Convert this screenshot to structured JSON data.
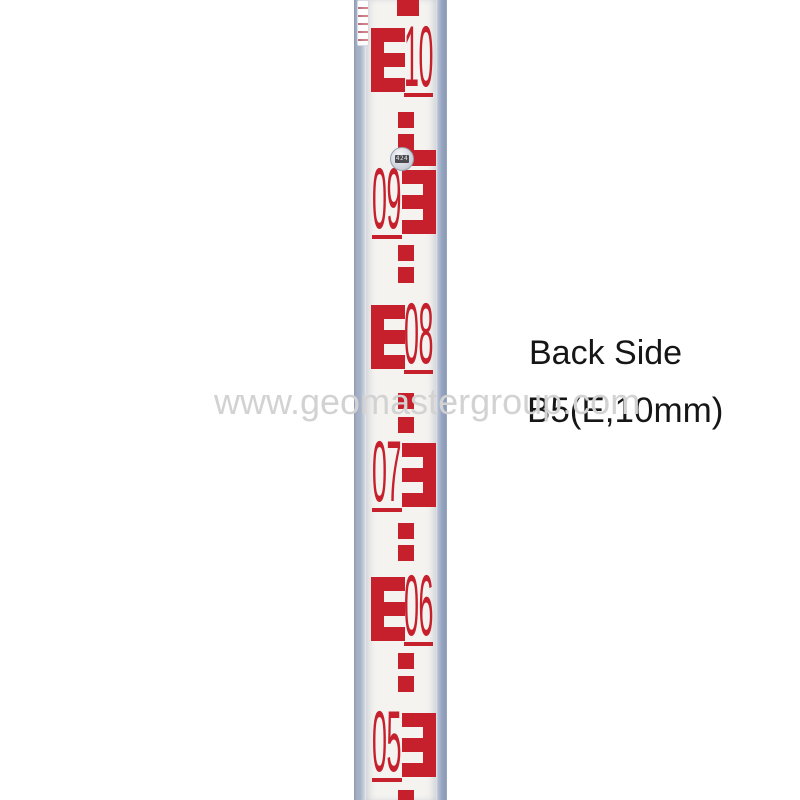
{
  "annotations": {
    "back_side_label": "Back Side",
    "model_label": "B5(E,10mm)",
    "watermark": "www.geomastergroup.com"
  },
  "staff": {
    "description": "aluminium levelling staff, back side, E-type 10mm graduations",
    "colors": {
      "graduation_red": "#c6202c",
      "face_white": "#f4f3f0",
      "rail_grey": "#a6b1c6"
    },
    "sticker_text": "424",
    "e_glyph": "E",
    "graduations": [
      {
        "digits": "10",
        "orientation": "upright",
        "top": 28
      },
      {
        "digits": "09",
        "orientation": "inverted",
        "top": 170
      },
      {
        "digits": "08",
        "orientation": "upright",
        "top": 305
      },
      {
        "digits": "07",
        "orientation": "inverted",
        "top": 443
      },
      {
        "digits": "06",
        "orientation": "upright",
        "top": 577
      },
      {
        "digits": "05",
        "orientation": "inverted",
        "top": 713
      }
    ],
    "blocks": [
      {
        "y": 0,
        "x": 31,
        "w": 22,
        "h": 16
      },
      {
        "y": 112
      },
      {
        "y": 134
      },
      {
        "y": 150,
        "x": 37,
        "w": 33
      },
      {
        "y": 245
      },
      {
        "y": 267
      },
      {
        "y": 393
      },
      {
        "y": 417
      },
      {
        "y": 523
      },
      {
        "y": 545
      },
      {
        "y": 653
      },
      {
        "y": 676
      },
      {
        "y": 790,
        "h": 10
      }
    ]
  }
}
